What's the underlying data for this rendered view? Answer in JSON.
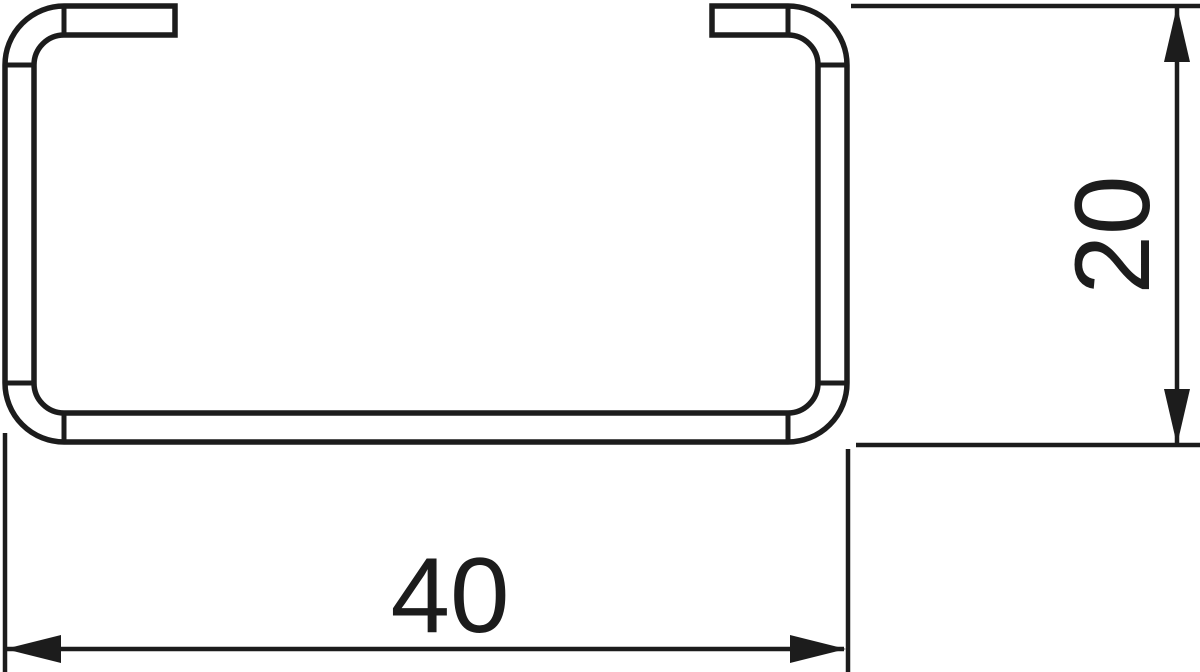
{
  "drawing": {
    "background_color": "#ffffff",
    "line_color": "#1c1c1c",
    "dimensions": {
      "width_label": "40",
      "height_label": "20"
    }
  }
}
